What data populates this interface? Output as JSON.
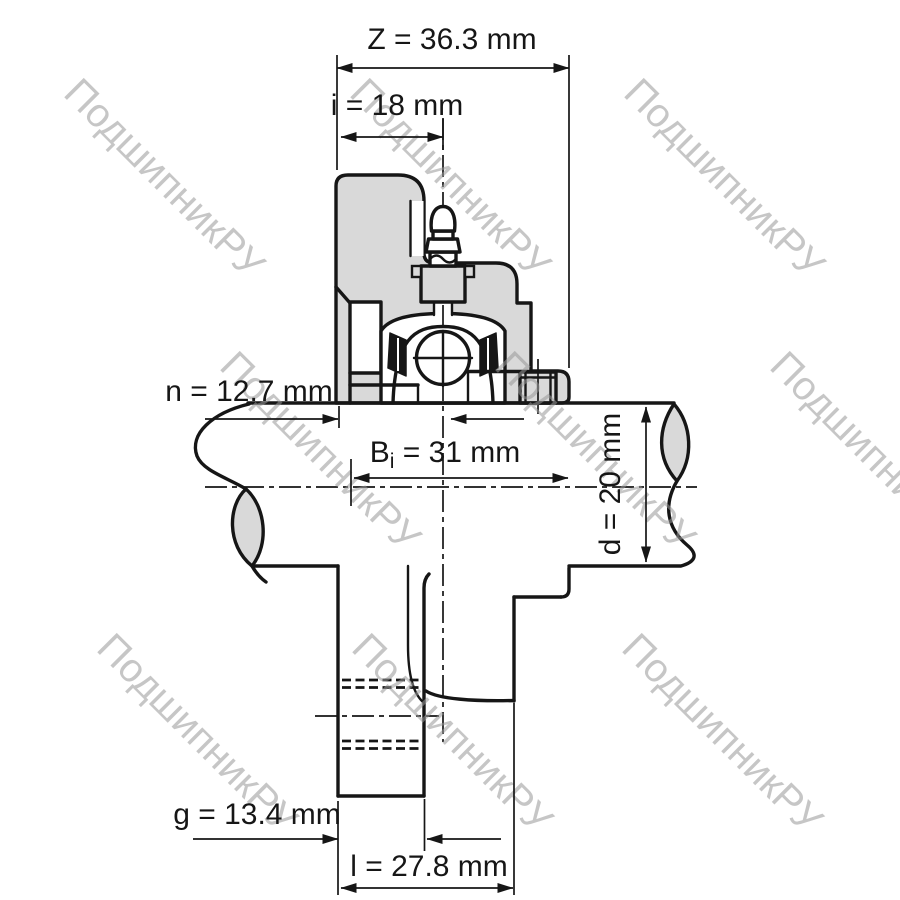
{
  "watermark": {
    "text": "ПодшипникРУ",
    "color": "#c6c6c6"
  },
  "drawing_colors": {
    "line": "#161616",
    "section_fill": "#d9d9d9",
    "background": "#ffffff"
  },
  "dimensions": {
    "z": {
      "label": "Z = 36.3 mm",
      "symbol": "Z",
      "value": 36.3,
      "unit": "mm"
    },
    "i": {
      "label": "i = 18 mm",
      "symbol": "i",
      "value": 18,
      "unit": "mm"
    },
    "n": {
      "label": "n = 12.7 mm",
      "symbol": "n",
      "value": 12.7,
      "unit": "mm"
    },
    "bi": {
      "label": "Bi = 31 mm",
      "base": "B",
      "sub": "i",
      "rest": " = 31 mm",
      "value": 31,
      "unit": "mm"
    },
    "d": {
      "label": "d = 20 mm",
      "symbol": "d",
      "value": 20,
      "unit": "mm"
    },
    "g": {
      "label": "g = 13.4 mm",
      "symbol": "g",
      "value": 13.4,
      "unit": "mm"
    },
    "l": {
      "label": "l = 27.8 mm",
      "symbol": "l",
      "value": 27.8,
      "unit": "mm"
    }
  }
}
